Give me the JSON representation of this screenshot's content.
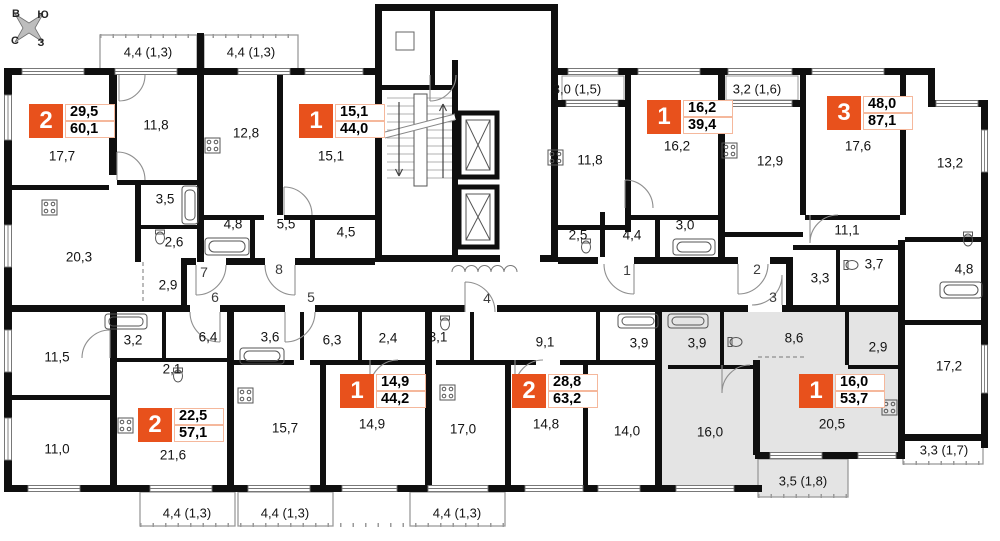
{
  "colors": {
    "accent": "#E8511C",
    "highlight_fill": "#e4e4e4"
  },
  "compass": {
    "labels": [
      [
        "В",
        16,
        14
      ],
      [
        "Ю",
        43,
        15
      ],
      [
        "С",
        15,
        41
      ],
      [
        "З",
        41,
        43
      ]
    ]
  },
  "apartments": [
    {
      "key": "top-left-2room",
      "badge": {
        "rooms": "2",
        "living": "29,5",
        "total": "60,1"
      },
      "badge_pos": {
        "x": 29,
        "y": 104
      },
      "room_areas": [
        [
          "17,7",
          62,
          156
        ],
        [
          "11,8",
          156,
          125
        ],
        [
          "3,5",
          165,
          199
        ],
        [
          "2,6",
          174,
          242
        ],
        [
          "2,9",
          168,
          285
        ],
        [
          "20,3",
          79,
          257
        ]
      ]
    },
    {
      "key": "top-1room-44",
      "badge": {
        "rooms": "1",
        "living": "15,1",
        "total": "44,0"
      },
      "badge_pos": {
        "x": 299,
        "y": 104
      },
      "room_areas": [
        [
          "12,8",
          246,
          133
        ],
        [
          "15,1",
          331,
          156
        ],
        [
          "4,8",
          233,
          224
        ],
        [
          "5,5",
          286,
          224
        ],
        [
          "4,5",
          346,
          232
        ]
      ]
    },
    {
      "key": "top-1room-39",
      "badge": {
        "rooms": "1",
        "living": "16,2",
        "total": "39,4"
      },
      "badge_pos": {
        "x": 647,
        "y": 100
      },
      "room_areas": [
        [
          "11,8",
          590,
          160
        ],
        [
          "16,2",
          677,
          146
        ],
        [
          "2,5",
          578,
          235
        ],
        [
          "4,4",
          632,
          235
        ],
        [
          "3,0",
          685,
          225
        ]
      ]
    },
    {
      "key": "top-right-3room",
      "badge": {
        "rooms": "3",
        "living": "48,0",
        "total": "87,1"
      },
      "badge_pos": {
        "x": 827,
        "y": 96
      },
      "room_areas": [
        [
          "12,9",
          770,
          161
        ],
        [
          "17,6",
          858,
          146
        ],
        [
          "13,2",
          950,
          163
        ],
        [
          "11,1",
          847,
          230
        ],
        [
          "3,3",
          820,
          278
        ],
        [
          "3,7",
          874,
          264
        ],
        [
          "4,8",
          964,
          269
        ],
        [
          "17,2",
          949,
          366
        ]
      ]
    },
    {
      "key": "bottom-left-2room",
      "badge": {
        "rooms": "2",
        "living": "22,5",
        "total": "57,1"
      },
      "badge_pos": {
        "x": 138,
        "y": 408
      },
      "room_areas": [
        [
          "11,5",
          57,
          357
        ],
        [
          "3,2",
          133,
          340
        ],
        [
          "6,4",
          208,
          337
        ],
        [
          "2,1",
          172,
          369
        ],
        [
          "11,0",
          57,
          449
        ],
        [
          "21,6",
          173,
          455
        ]
      ]
    },
    {
      "key": "bottom-1room-44",
      "badge": {
        "rooms": "1",
        "living": "14,9",
        "total": "44,2"
      },
      "badge_pos": {
        "x": 340,
        "y": 374
      },
      "room_areas": [
        [
          "3,6",
          270,
          337
        ],
        [
          "6,3",
          332,
          340
        ],
        [
          "2,4",
          388,
          338
        ],
        [
          "15,7",
          285,
          428
        ],
        [
          "14,9",
          372,
          424
        ]
      ]
    },
    {
      "key": "bottom-2room-63",
      "badge": {
        "rooms": "2",
        "living": "28,8",
        "total": "63,2"
      },
      "badge_pos": {
        "x": 512,
        "y": 374
      },
      "room_areas": [
        [
          "3,1",
          438,
          337
        ],
        [
          "9,1",
          545,
          342
        ],
        [
          "3,9",
          639,
          343
        ],
        [
          "17,0",
          463,
          429
        ],
        [
          "14,8",
          546,
          424
        ],
        [
          "14,0",
          627,
          431
        ]
      ]
    },
    {
      "key": "bottom-right-1room-highlighted",
      "badge": {
        "rooms": "1",
        "living": "16,0",
        "total": "53,7"
      },
      "badge_pos": {
        "x": 799,
        "y": 374
      },
      "room_areas": [
        [
          "3,9",
          697,
          343
        ],
        [
          "8,6",
          794,
          338
        ],
        [
          "2,9",
          878,
          347
        ],
        [
          "20,5",
          832,
          424
        ],
        [
          "16,0",
          710,
          432
        ]
      ]
    }
  ],
  "balconies": [
    [
      "4,4 (1,3)",
      148,
      52
    ],
    [
      "4,4 (1,3)",
      251,
      52
    ],
    [
      "3,0 (1,5)",
      577,
      89
    ],
    [
      "3,2 (1,6)",
      757,
      89
    ],
    [
      "4,4 (1,3)",
      187,
      513
    ],
    [
      "4,4 (1,3)",
      285,
      513
    ],
    [
      "4,4 (1,3)",
      457,
      513
    ],
    [
      "3,5 (1,8)",
      803,
      481
    ],
    [
      "3,3 (1,7)",
      944,
      450
    ]
  ],
  "unit_numbers": [
    [
      "1",
      627,
      270
    ],
    [
      "2",
      757,
      269
    ],
    [
      "3",
      773,
      297
    ],
    [
      "4",
      487,
      298
    ],
    [
      "5",
      311,
      297
    ],
    [
      "6",
      215,
      297
    ],
    [
      "7",
      204,
      272
    ],
    [
      "8",
      279,
      269
    ]
  ]
}
